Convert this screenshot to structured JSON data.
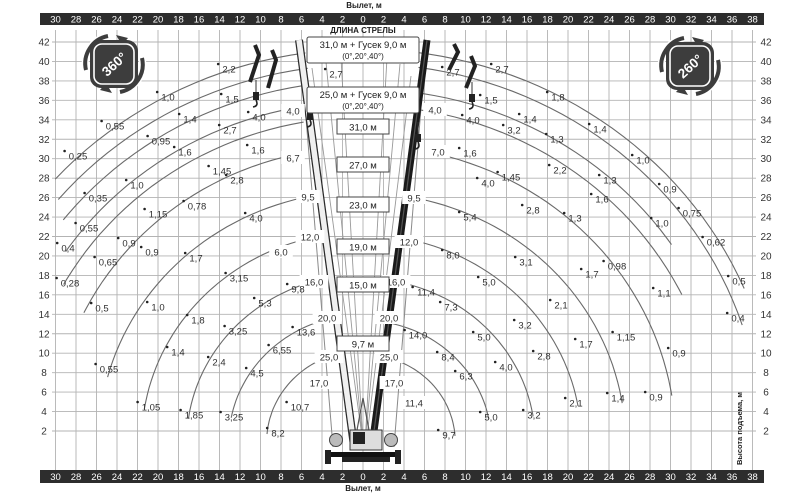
{
  "axes": {
    "outreach_title_top": "Вылет, м",
    "outreach_title_bottom": "Вылет, м",
    "height_title": "Высота подъема, м",
    "outreach_ticks": [
      30,
      28,
      26,
      24,
      22,
      20,
      18,
      16,
      14,
      12,
      10,
      8,
      6,
      4,
      2,
      0,
      2,
      4,
      6,
      8,
      10,
      12,
      14,
      16,
      18,
      20,
      22,
      24,
      26,
      28,
      30,
      32,
      34,
      36,
      38
    ],
    "height_ticks": [
      42,
      40,
      38,
      36,
      34,
      32,
      30,
      28,
      26,
      24,
      22,
      20,
      18,
      16,
      14,
      12,
      10,
      8,
      6,
      4,
      2
    ]
  },
  "badges": {
    "left": "360°",
    "right": "260°"
  },
  "boom_legend": {
    "title": "ДЛИНА СТРЕЛЫ",
    "jib_boxes": [
      {
        "line1": "31,0 м + Гусек 9,0 м",
        "line2": "(0°,20°,40°)",
        "cx": 363,
        "cy": 50
      },
      {
        "line1": "25,0 м + Гусек 9,0 м",
        "line2": "(0°,20°,40°)",
        "cx": 363,
        "cy": 100
      }
    ],
    "length_boxes": [
      {
        "label": "31,0 м",
        "cx": 363,
        "cy": 127
      },
      {
        "label": "27,0 м",
        "cx": 363,
        "cy": 165
      },
      {
        "label": "23,0 м",
        "cx": 363,
        "cy": 205
      },
      {
        "label": "19,0 м",
        "cx": 363,
        "cy": 247
      },
      {
        "label": "15,0 м",
        "cx": 363,
        "cy": 285
      },
      {
        "label": "9,7 м",
        "cx": 363,
        "cy": 344
      }
    ]
  },
  "colors": {
    "bar": "#2d2d2d",
    "bar_text": "#ffffff",
    "grid": "#b3b3b3",
    "curve": "#6a6a6a",
    "label": "#2f2f2f",
    "badge": "#3d3d3d",
    "box_stroke": "#444444",
    "boom_dark": "#1a1a1a",
    "boom_light": "#f0f0f0",
    "boom_stroke": "#2b2b2b"
  },
  "chart_data": {
    "type": "crane-load-height-diagram",
    "units": {
      "outreach": "м",
      "height": "м",
      "load": "т"
    },
    "scale": {
      "origin_x": 363,
      "pivot_y": 442,
      "px_per_m_x": 10.25,
      "px_per_m_y": 9.725,
      "x_first_px": 55.5,
      "x_step_px": 20.5,
      "y_top_px": 42,
      "grid_y1": 30,
      "grid_y2": 470,
      "grid_x1": 52,
      "grid_x2": 756
    },
    "curves": {
      "left": [
        [
          40.4,
          8,
          48
        ],
        [
          38.8,
          8,
          50
        ],
        [
          37.1,
          9,
          52
        ],
        [
          35.0,
          9,
          56
        ],
        [
          33.4,
          10,
          61
        ],
        [
          30.3,
          11,
          64
        ],
        [
          25.8,
          11,
          75
        ],
        [
          21.6,
          13,
          81
        ],
        [
          17.2,
          15,
          82
        ],
        [
          13.1,
          15,
          79
        ],
        [
          9.4,
          19,
          85
        ]
      ],
      "right": [
        [
          40.4,
          7,
          67
        ],
        [
          38.9,
          8,
          72
        ],
        [
          36.3,
          9,
          56
        ],
        [
          34.6,
          9,
          64
        ],
        [
          30.5,
          12,
          81
        ],
        [
          25.6,
          10,
          81
        ],
        [
          21.3,
          11,
          80
        ],
        [
          16.8,
          10,
          81
        ],
        [
          12.5,
          10,
          79
        ],
        [
          9.0,
          12,
          86
        ]
      ]
    },
    "load_labels": [
      {
        "t": "2,2",
        "x": 229,
        "y": 69
      },
      {
        "t": "2,7",
        "x": 336,
        "y": 74
      },
      {
        "t": "1,0",
        "x": 168,
        "y": 97
      },
      {
        "t": "1,5",
        "x": 232,
        "y": 99
      },
      {
        "t": "1,4",
        "x": 190,
        "y": 119
      },
      {
        "t": "4,0",
        "x": 259,
        "y": 117
      },
      {
        "t": "4,0",
        "x": 293,
        "y": 111,
        "b": 1
      },
      {
        "t": "0,55",
        "x": 115,
        "y": 126
      },
      {
        "t": "2,7",
        "x": 230,
        "y": 130
      },
      {
        "t": "0,95",
        "x": 161,
        "y": 141
      },
      {
        "t": "1,6",
        "x": 185,
        "y": 152
      },
      {
        "t": "1,6",
        "x": 258,
        "y": 150
      },
      {
        "t": "0,25",
        "x": 78,
        "y": 156
      },
      {
        "t": "6,7",
        "x": 293,
        "y": 158,
        "b": 1
      },
      {
        "t": "1,45",
        "x": 222,
        "y": 171
      },
      {
        "t": "2,8",
        "x": 237,
        "y": 180
      },
      {
        "t": "1,0",
        "x": 137,
        "y": 185
      },
      {
        "t": "0,35",
        "x": 98,
        "y": 198
      },
      {
        "t": "9,5",
        "x": 308,
        "y": 197,
        "b": 1
      },
      {
        "t": "0,78",
        "x": 197,
        "y": 206
      },
      {
        "t": "1,15",
        "x": 158,
        "y": 214
      },
      {
        "t": "4,0",
        "x": 256,
        "y": 218
      },
      {
        "t": "0,55",
        "x": 89,
        "y": 228
      },
      {
        "t": "12,0",
        "x": 310,
        "y": 237,
        "b": 1
      },
      {
        "t": "0,9",
        "x": 129,
        "y": 243
      },
      {
        "t": "0,4",
        "x": 68,
        "y": 248
      },
      {
        "t": "0,9",
        "x": 152,
        "y": 252
      },
      {
        "t": "6,0",
        "x": 281,
        "y": 252,
        "b": 1
      },
      {
        "t": "1,7",
        "x": 196,
        "y": 258
      },
      {
        "t": "0,65",
        "x": 108,
        "y": 262
      },
      {
        "t": "3,15",
        "x": 239,
        "y": 278
      },
      {
        "t": "0,28",
        "x": 70,
        "y": 283
      },
      {
        "t": "16,0",
        "x": 314,
        "y": 282,
        "b": 1
      },
      {
        "t": "9,8",
        "x": 298,
        "y": 289
      },
      {
        "t": "5,3",
        "x": 265,
        "y": 303
      },
      {
        "t": "0,5",
        "x": 102,
        "y": 308
      },
      {
        "t": "1,0",
        "x": 158,
        "y": 307
      },
      {
        "t": "1,8",
        "x": 198,
        "y": 320
      },
      {
        "t": "20,0",
        "x": 327,
        "y": 318,
        "b": 1
      },
      {
        "t": "13,6",
        "x": 306,
        "y": 332
      },
      {
        "t": "3,25",
        "x": 238,
        "y": 331
      },
      {
        "t": "6,55",
        "x": 282,
        "y": 350
      },
      {
        "t": "1,4",
        "x": 178,
        "y": 352
      },
      {
        "t": "2,4",
        "x": 219,
        "y": 362
      },
      {
        "t": "25,0",
        "x": 329,
        "y": 357,
        "b": 1
      },
      {
        "t": "4,5",
        "x": 257,
        "y": 373
      },
      {
        "t": "0,55",
        "x": 109,
        "y": 369
      },
      {
        "t": "17,0",
        "x": 319,
        "y": 383,
        "b": 1
      },
      {
        "t": "1,05",
        "x": 151,
        "y": 407
      },
      {
        "t": "10,7",
        "x": 300,
        "y": 407
      },
      {
        "t": "1,85",
        "x": 194,
        "y": 415
      },
      {
        "t": "3,25",
        "x": 234,
        "y": 417
      },
      {
        "t": "8,2",
        "x": 278,
        "y": 433
      },
      {
        "t": "2,7",
        "x": 453,
        "y": 72
      },
      {
        "t": "2,7",
        "x": 502,
        "y": 69
      },
      {
        "t": "1,5",
        "x": 491,
        "y": 100
      },
      {
        "t": "1,8",
        "x": 558,
        "y": 97
      },
      {
        "t": "4,0",
        "x": 435,
        "y": 110,
        "b": 1
      },
      {
        "t": "4,0",
        "x": 473,
        "y": 120
      },
      {
        "t": "1,4",
        "x": 530,
        "y": 119
      },
      {
        "t": "3,2",
        "x": 514,
        "y": 130
      },
      {
        "t": "1,4",
        "x": 600,
        "y": 129
      },
      {
        "t": "1,3",
        "x": 557,
        "y": 139
      },
      {
        "t": "7,0",
        "x": 438,
        "y": 152,
        "b": 1
      },
      {
        "t": "1,6",
        "x": 470,
        "y": 153
      },
      {
        "t": "1,0",
        "x": 643,
        "y": 160
      },
      {
        "t": "2,2",
        "x": 560,
        "y": 170
      },
      {
        "t": "1,45",
        "x": 511,
        "y": 177
      },
      {
        "t": "1,3",
        "x": 610,
        "y": 180
      },
      {
        "t": "4,0",
        "x": 488,
        "y": 183
      },
      {
        "t": "0,9",
        "x": 670,
        "y": 189
      },
      {
        "t": "9,5",
        "x": 414,
        "y": 198,
        "b": 1
      },
      {
        "t": "1,6",
        "x": 602,
        "y": 199
      },
      {
        "t": "2,8",
        "x": 533,
        "y": 210
      },
      {
        "t": "5,4",
        "x": 470,
        "y": 217
      },
      {
        "t": "0,75",
        "x": 692,
        "y": 213
      },
      {
        "t": "1,3",
        "x": 575,
        "y": 218
      },
      {
        "t": "1,0",
        "x": 662,
        "y": 223
      },
      {
        "t": "12,0",
        "x": 409,
        "y": 242,
        "b": 1
      },
      {
        "t": "0,62",
        "x": 716,
        "y": 242
      },
      {
        "t": "8,0",
        "x": 453,
        "y": 255
      },
      {
        "t": "3,1",
        "x": 526,
        "y": 262
      },
      {
        "t": "0,98",
        "x": 617,
        "y": 266
      },
      {
        "t": "1,7",
        "x": 592,
        "y": 274
      },
      {
        "t": "0,5",
        "x": 739,
        "y": 281
      },
      {
        "t": "16,0",
        "x": 396,
        "y": 282,
        "b": 1
      },
      {
        "t": "11,4",
        "x": 426,
        "y": 292
      },
      {
        "t": "5,0",
        "x": 489,
        "y": 282
      },
      {
        "t": "1,1",
        "x": 664,
        "y": 293
      },
      {
        "t": "7,3",
        "x": 451,
        "y": 307
      },
      {
        "t": "2,1",
        "x": 561,
        "y": 305
      },
      {
        "t": "0,4",
        "x": 738,
        "y": 318
      },
      {
        "t": "20,0",
        "x": 389,
        "y": 318,
        "b": 1
      },
      {
        "t": "3,2",
        "x": 525,
        "y": 325
      },
      {
        "t": "14,0",
        "x": 418,
        "y": 335
      },
      {
        "t": "5,0",
        "x": 484,
        "y": 337
      },
      {
        "t": "1,15",
        "x": 626,
        "y": 337
      },
      {
        "t": "1,7",
        "x": 586,
        "y": 344
      },
      {
        "t": "2,8",
        "x": 544,
        "y": 356
      },
      {
        "t": "0,9",
        "x": 679,
        "y": 353
      },
      {
        "t": "25,0",
        "x": 389,
        "y": 357,
        "b": 1
      },
      {
        "t": "8,4",
        "x": 448,
        "y": 357
      },
      {
        "t": "4,0",
        "x": 506,
        "y": 367
      },
      {
        "t": "6,3",
        "x": 466,
        "y": 376
      },
      {
        "t": "17,0",
        "x": 394,
        "y": 383,
        "b": 1
      },
      {
        "t": "0,9",
        "x": 656,
        "y": 397
      },
      {
        "t": "1,4",
        "x": 618,
        "y": 398
      },
      {
        "t": "2,1",
        "x": 576,
        "y": 403
      },
      {
        "t": "11,4",
        "x": 414,
        "y": 403,
        "b": 1
      },
      {
        "t": "3,2",
        "x": 534,
        "y": 415
      },
      {
        "t": "5,0",
        "x": 491,
        "y": 417
      },
      {
        "t": "9,7",
        "x": 449,
        "y": 435
      }
    ]
  }
}
